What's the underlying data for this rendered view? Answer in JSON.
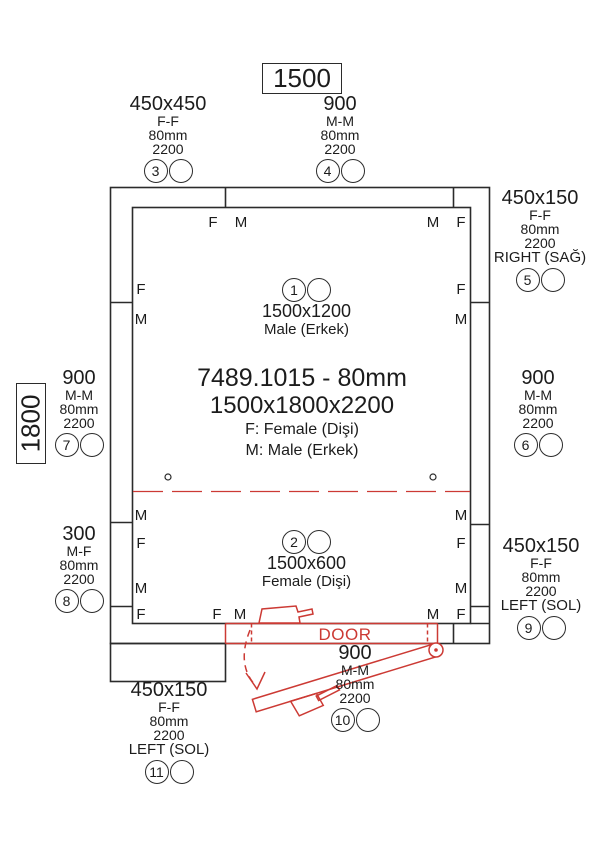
{
  "drawing": {
    "part_code_line": "7489.1015 - 80mm",
    "overall_size_line": "1500x1800x2200",
    "legend_f": "F: Female (Dişi)",
    "legend_m": "M: Male (Erkek)",
    "width_dim": "1500",
    "depth_dim": "1800",
    "door_label": "DOOR"
  },
  "glyphs": {
    "F": "F",
    "M": "M"
  },
  "inner_panels": [
    {
      "num": "1",
      "size": "1500x1200",
      "gender": "Male (Erkek)"
    },
    {
      "num": "2",
      "size": "1500x600",
      "gender": "Female (Dişi)"
    }
  ],
  "callouts": [
    {
      "num": "3",
      "size": "450x450",
      "joint": "F-F",
      "thickness": "80mm",
      "height": "2200",
      "side": ""
    },
    {
      "num": "4",
      "size": "900",
      "joint": "M-M",
      "thickness": "80mm",
      "height": "2200",
      "side": ""
    },
    {
      "num": "5",
      "size": "450x150",
      "joint": "F-F",
      "thickness": "80mm",
      "height": "2200",
      "side": "RIGHT (SAĞ)"
    },
    {
      "num": "6",
      "size": "900",
      "joint": "M-M",
      "thickness": "80mm",
      "height": "2200",
      "side": ""
    },
    {
      "num": "7",
      "size": "900",
      "joint": "M-M",
      "thickness": "80mm",
      "height": "2200",
      "side": ""
    },
    {
      "num": "8",
      "size": "300",
      "joint": "M-F",
      "thickness": "80mm",
      "height": "2200",
      "side": ""
    },
    {
      "num": "9",
      "size": "450x150",
      "joint": "F-F",
      "thickness": "80mm",
      "height": "2200",
      "side": "LEFT (SOL)"
    },
    {
      "num": "10",
      "size": "900",
      "joint": "M-M",
      "thickness": "80mm",
      "height": "2200",
      "side": ""
    },
    {
      "num": "11",
      "size": "450x150",
      "joint": "F-F",
      "thickness": "80mm",
      "height": "2200",
      "side": "LEFT (SOL)"
    }
  ],
  "colors": {
    "line": "#2b2b2b",
    "accent_red": "#cc3a34",
    "background": "#ffffff"
  }
}
